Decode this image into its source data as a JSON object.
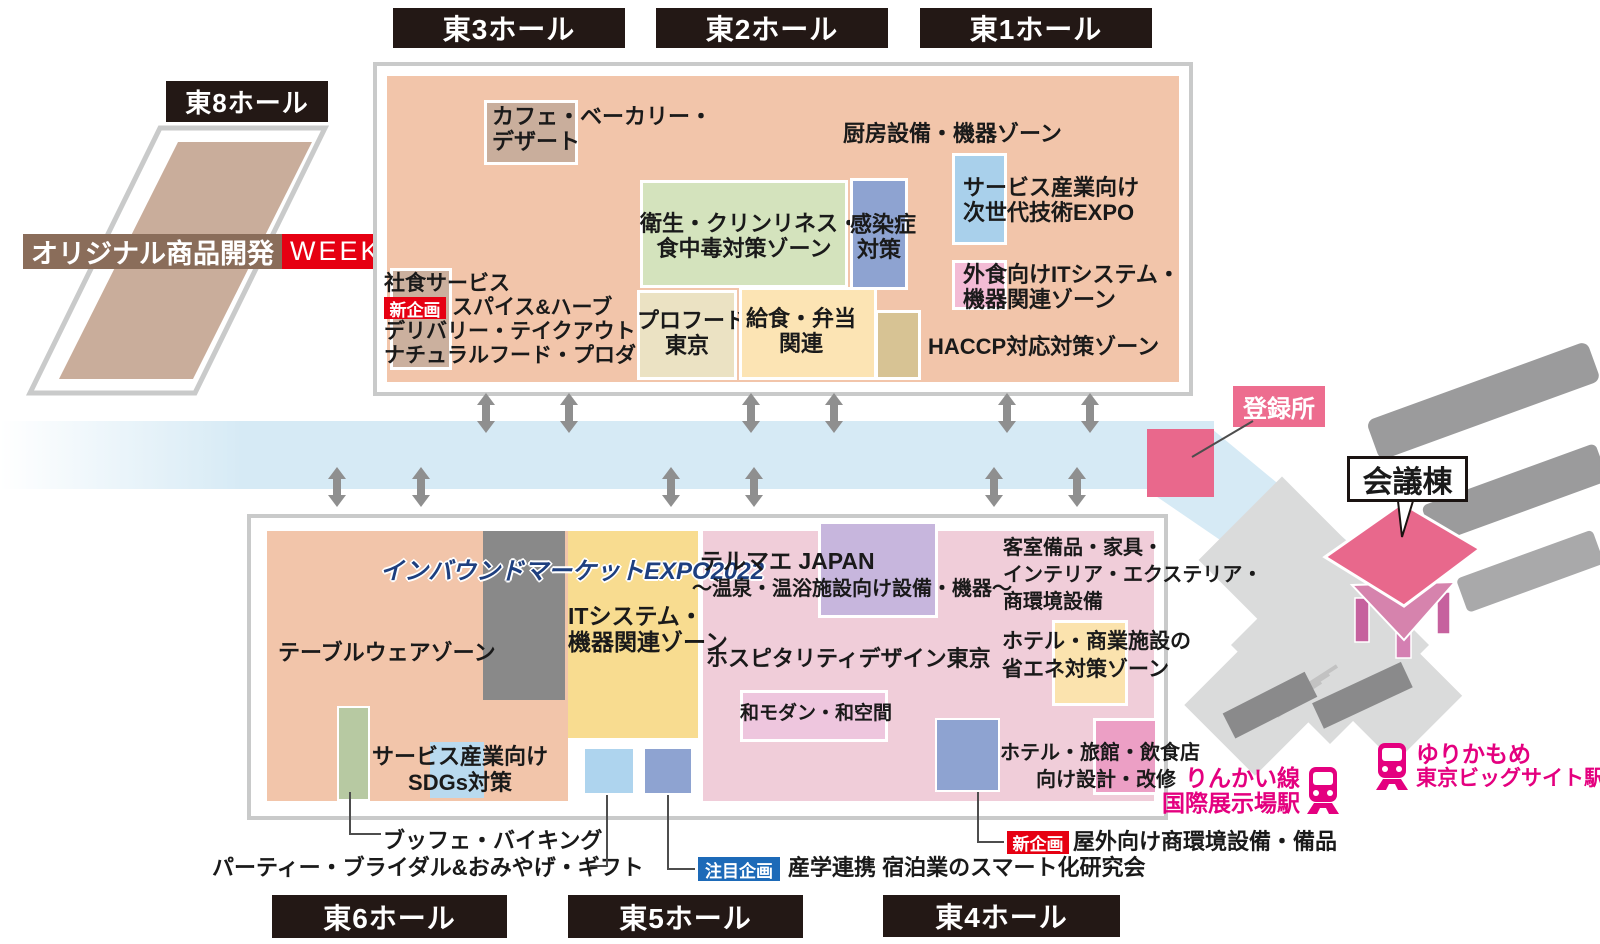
{
  "halls": {
    "e1": "東1ホール",
    "e2": "東2ホール",
    "e3": "東3ホール",
    "e4": "東4ホール",
    "e5": "東5ホール",
    "e6": "東6ホール",
    "e8": "東8ホール"
  },
  "week_banner": {
    "main": "オリジナル商品開発",
    "week": "WEEK"
  },
  "badges": {
    "new": "新企画",
    "featured": "注目企画"
  },
  "registration_label": "登録所",
  "conference_label": "会議棟",
  "upper_building": {
    "cafe": [
      "カフェ・ベーカリー・",
      "デザート"
    ],
    "kitchen_zone": "厨房設備・機器ゾーン",
    "service_expo": [
      "サービス産業向け",
      "次世代技術EXPO"
    ],
    "hygiene_zone": [
      "衛生・クリンリネス・",
      "食中毒対策ゾーン"
    ],
    "infection": [
      "感染症",
      "対策"
    ],
    "restaurant_it": [
      "外食向けITシステム・",
      "機器関連ゾーン"
    ],
    "shashoku": "社食サービス",
    "spice": "スパイス&ハーブ",
    "delivery": "デリバリー・テイクアウト",
    "natural_food": "ナチュラルフード・プロダクツ",
    "profood": [
      "プロフード",
      "東京"
    ],
    "kyushoku": [
      "給食・弁当",
      "関連"
    ],
    "haccp": "HACCP対応対策ゾーン"
  },
  "lower_building": {
    "inbound": "インバウンドマーケットEXPO2022",
    "tableware": "テーブルウェアゾーン",
    "it_zone": [
      "ITシステム・",
      "機器関連ゾーン"
    ],
    "sdgs": [
      "サービス産業向け",
      "SDGs対策"
    ],
    "thermae": [
      "テルマエ JAPAN",
      "〜温泉・温浴施設向け設備・機器〜"
    ],
    "hospitality": "ホスピタリティデザイン東京",
    "wamodern": "和モダン・和空間",
    "guestroom": [
      "客室備品・家具・",
      "インテリア・エクステリア・",
      "商環境設備"
    ],
    "energy_saving": [
      "ホテル・商業施設の",
      "省エネ対策ゾーン"
    ],
    "hotel_design": [
      "ホテル・旅館・飲食店",
      "向け設計・改修"
    ]
  },
  "annotations": {
    "buffet": "ブッフェ・バイキング",
    "party": "パーティー・ブライダル&おみやげ・ギフト",
    "sangaku": "産学連携 宿泊業のスマート化研究会",
    "outdoor": "屋外向け商環境設備・備品"
  },
  "stations": {
    "rinkai": {
      "line": "りんかい線",
      "station": "国際展示場駅"
    },
    "yurikamome": {
      "line": "ゆりかもめ",
      "station": "東京ビッグサイト駅"
    }
  },
  "icons": [
    "train-icon",
    "double-arrow-icon"
  ],
  "colors": {
    "salmon": "#f2c5aa",
    "tan": "#c9ae9c",
    "green_zone": "#d4e3bd",
    "blue_purple": "#8ea3d1",
    "light_blue": "#a9d0eb",
    "pink_zone": "#f3bbd5",
    "cream": "#ebe2c3",
    "light_yellow": "#fce4b4",
    "khaki": "#d7c394",
    "yellow_section": "#f8dc90",
    "rose_section": "#f0cdd9",
    "purple_box": "#c7b6dd",
    "wamodern_pink": "#eec6de",
    "hotel_pink": "#ec9fc5",
    "magenta": "#e9688c",
    "station_pink": "#e4007f",
    "label_black": "#231815",
    "badge_red": "#e60012",
    "badge_blue": "#1d6ab8",
    "banner_brown": "#8a6d5a",
    "walkway_blue": "#d6eaf5",
    "gray_block": "#898989",
    "border_gray": "#c9caca",
    "inbound_navy": "#1e3f7f"
  }
}
